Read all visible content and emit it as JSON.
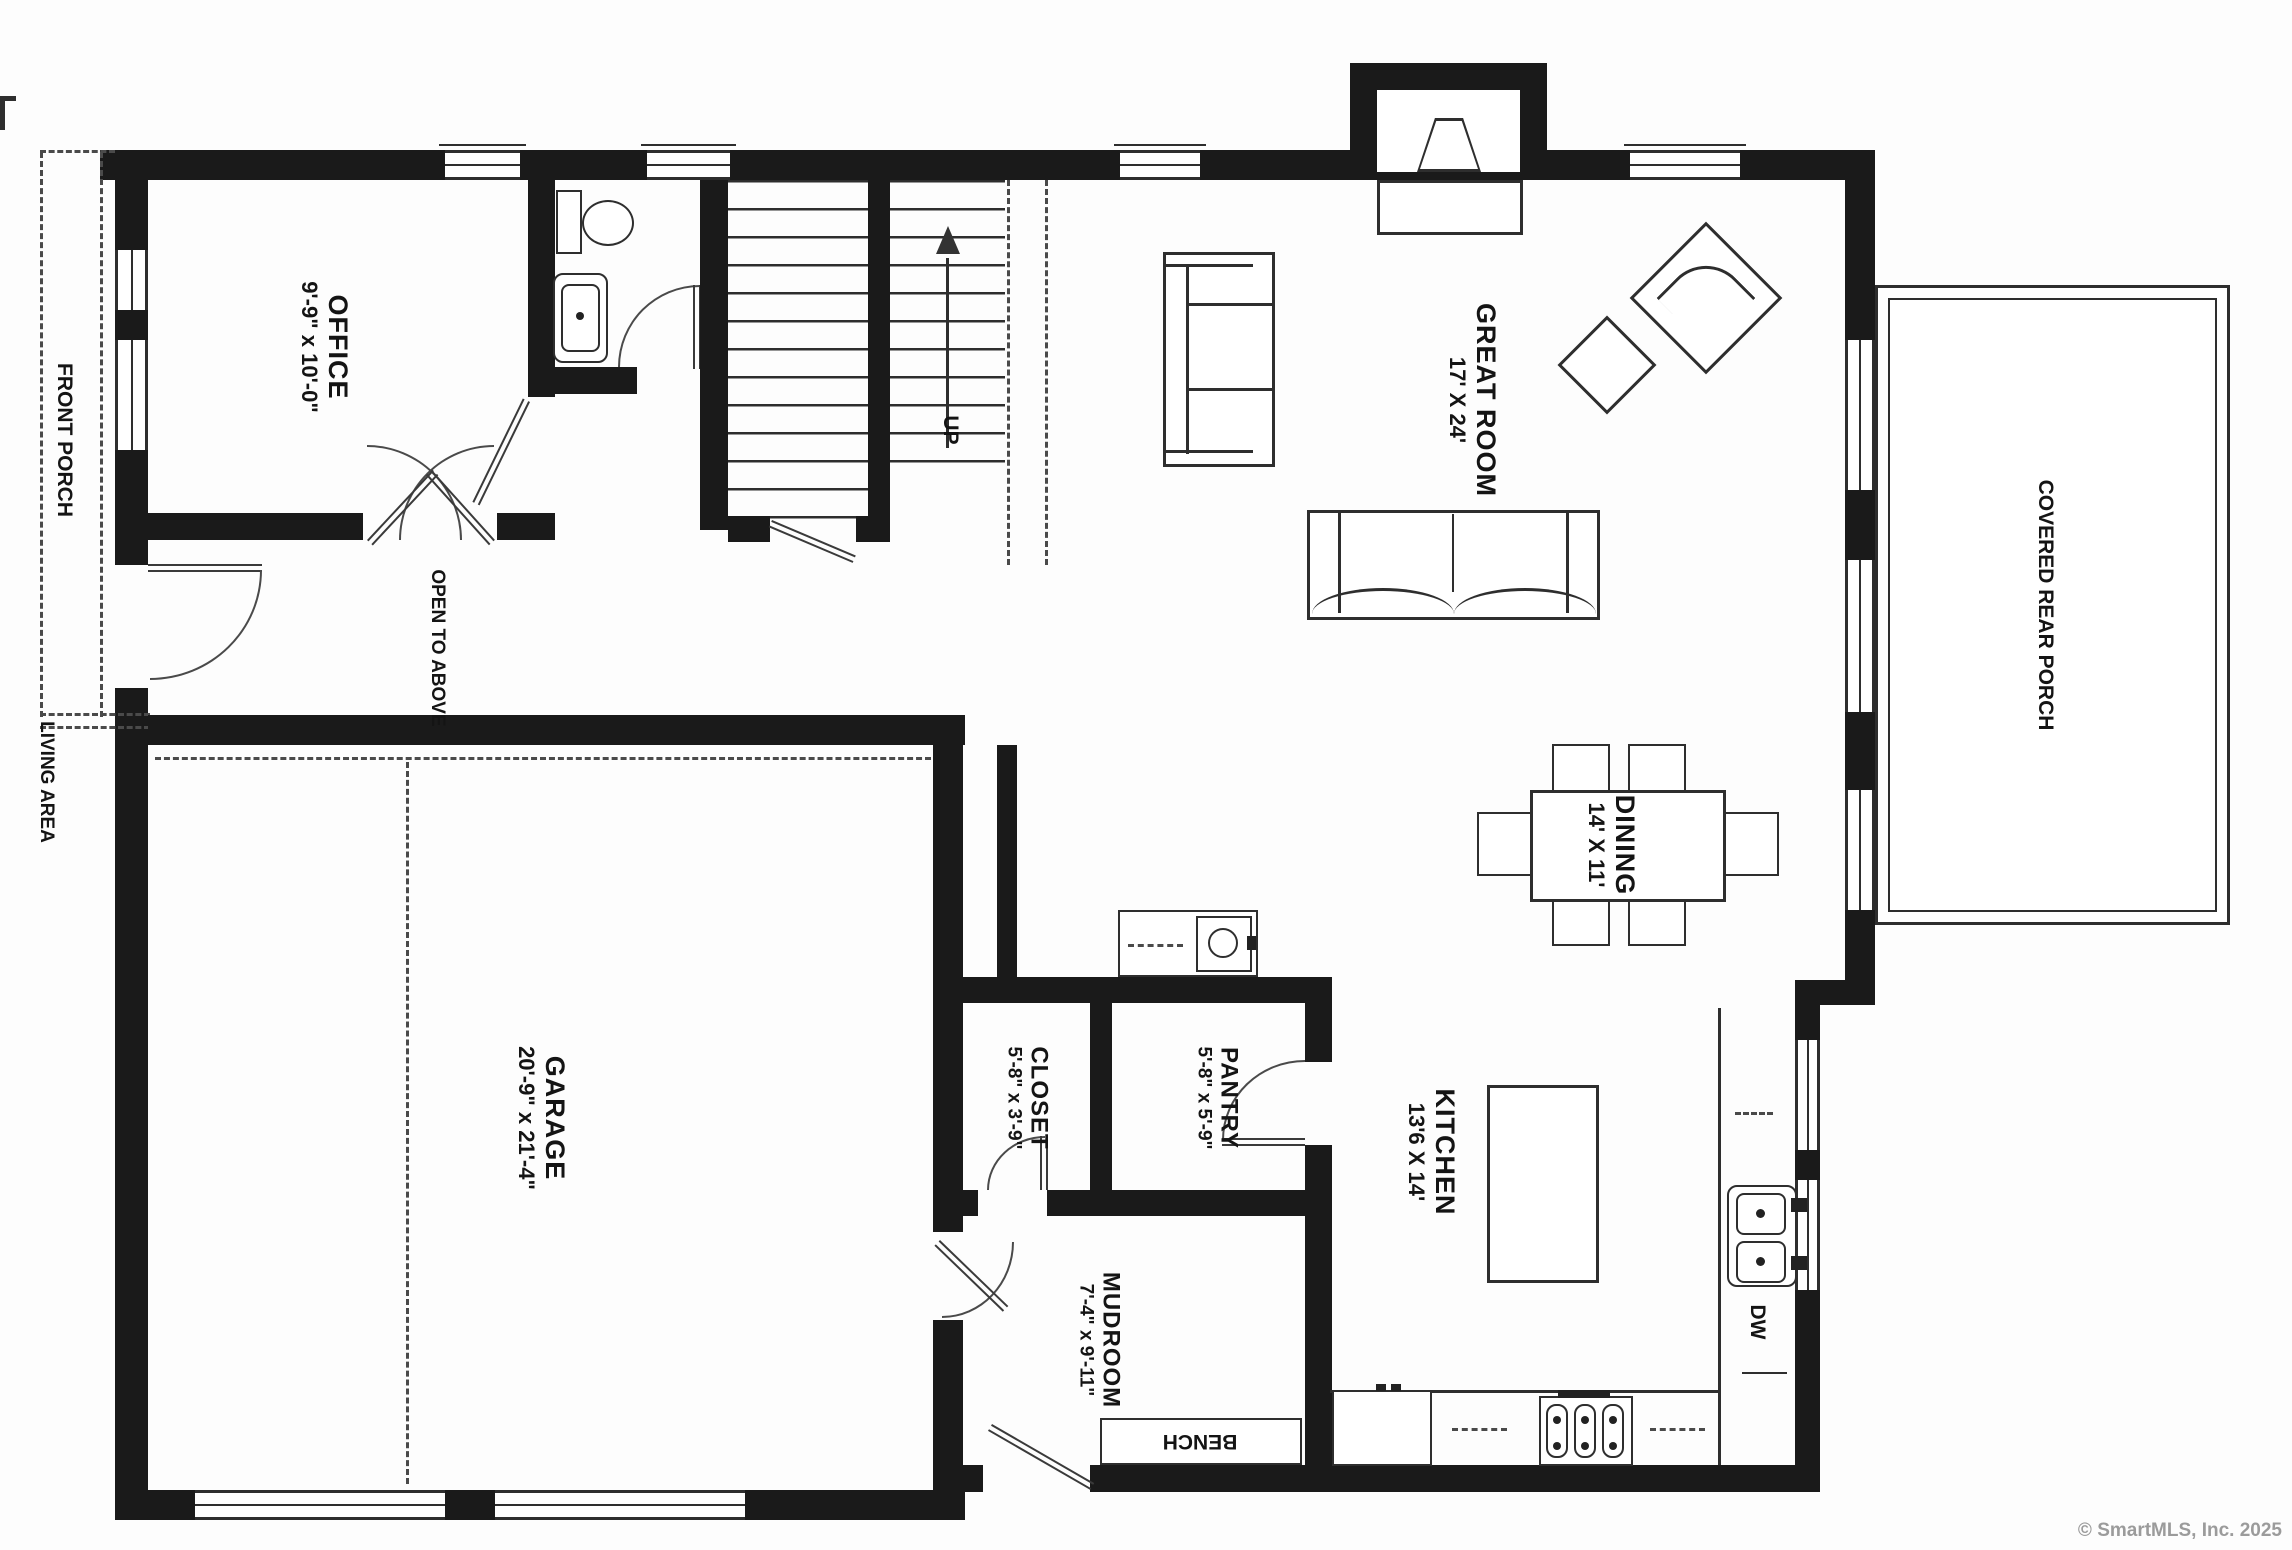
{
  "plan_title": "First floor plan",
  "rooms": {
    "office": {
      "name": "OFFICE",
      "dims": "9'-9\" x 10'-0\""
    },
    "great_room": {
      "name": "GREAT ROOM",
      "dims": "17' X 24'"
    },
    "dining": {
      "name": "DINING",
      "dims": "14' X 11'"
    },
    "kitchen": {
      "name": "KITCHEN",
      "dims": "13'6 X 14'"
    },
    "garage": {
      "name": "GARAGE",
      "dims": "20'-9\" x 21'-4\""
    },
    "closet": {
      "name": "CLOSET",
      "dims": "5'-8\" x 3'-9\""
    },
    "pantry": {
      "name": "PANTRY",
      "dims": "5'-8\" x 5'-9\""
    },
    "mudroom": {
      "name": "MUDROOM",
      "dims": "7'-4\" x 9'-11\""
    }
  },
  "areas": {
    "front_porch": "FRONT PORCH",
    "covered_rear_porch": "COVERED REAR PORCH",
    "living_area": "LIVING AREA",
    "open_to_above": "OPEN TO ABOVE",
    "up": "UP",
    "bench": "BENCH",
    "dw": "DW"
  },
  "footer": {
    "copyright": "© SmartMLS, Inc.  2025"
  },
  "colors": {
    "wall": "#1a1a1a",
    "line": "#2e2e2e",
    "paper": "#fdfdfd",
    "copyright": "#9b9b9b"
  }
}
